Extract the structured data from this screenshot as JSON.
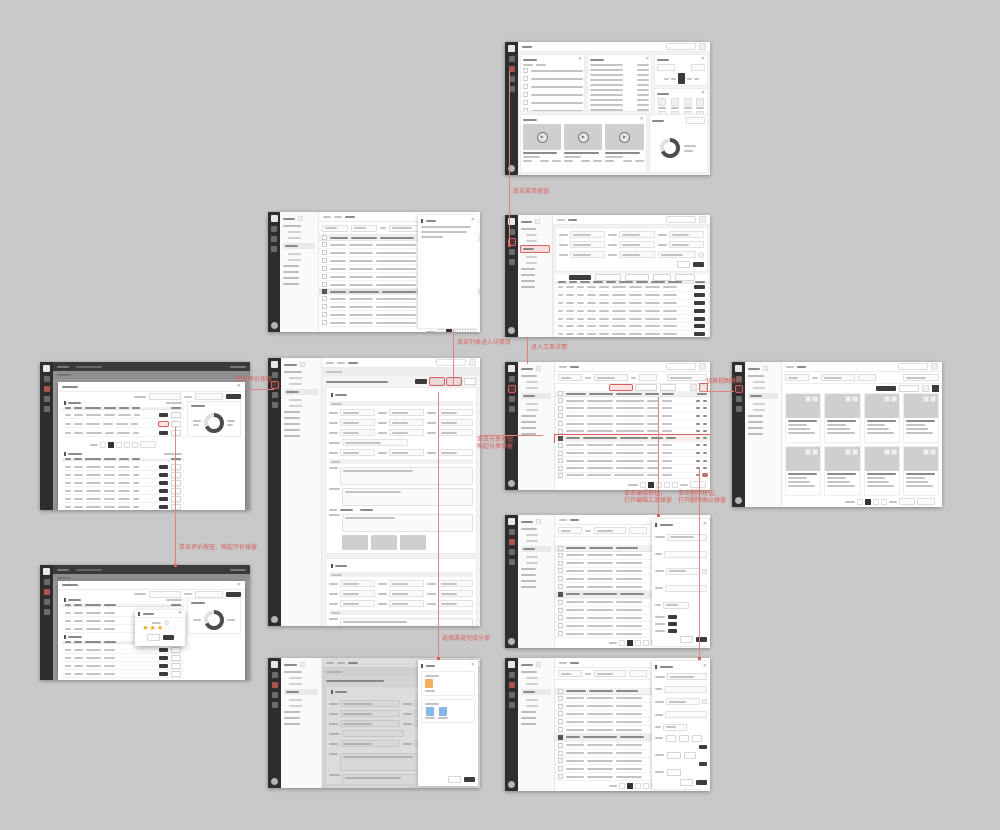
{
  "canvas": {
    "background": "#c9c9c9"
  },
  "colors": {
    "accent_red": "#d9605c",
    "connector_red": "#e0847e",
    "sidebar_dark": "#2e2e2e",
    "button_dark": "#3c3c3c",
    "star_yellow": "#f0a828",
    "share_orange": "#f2b05e",
    "share_blue": "#85b8e8"
  },
  "icons": {
    "close": "✕",
    "play": "▶",
    "star_filled": "★",
    "star_empty": "☆"
  },
  "annotations": [
    {
      "text": "单击菜单按钮"
    },
    {
      "text": "双击列表进入详情页"
    },
    {
      "text": "进入工单详情"
    },
    {
      "text": "单击分享按钮，\n唤起分享弹窗"
    },
    {
      "text": "选择渠道完成分享"
    },
    {
      "text": "单击编辑按钮，\n打开编辑工单弹窗"
    },
    {
      "text": "单击删除按钮，\n打开删除确认弹窗"
    },
    {
      "text": "单击评价按钮，唤起评价弹窗"
    },
    {
      "text": "单击评价按钮"
    },
    {
      "text": "切换视图模式"
    }
  ]
}
